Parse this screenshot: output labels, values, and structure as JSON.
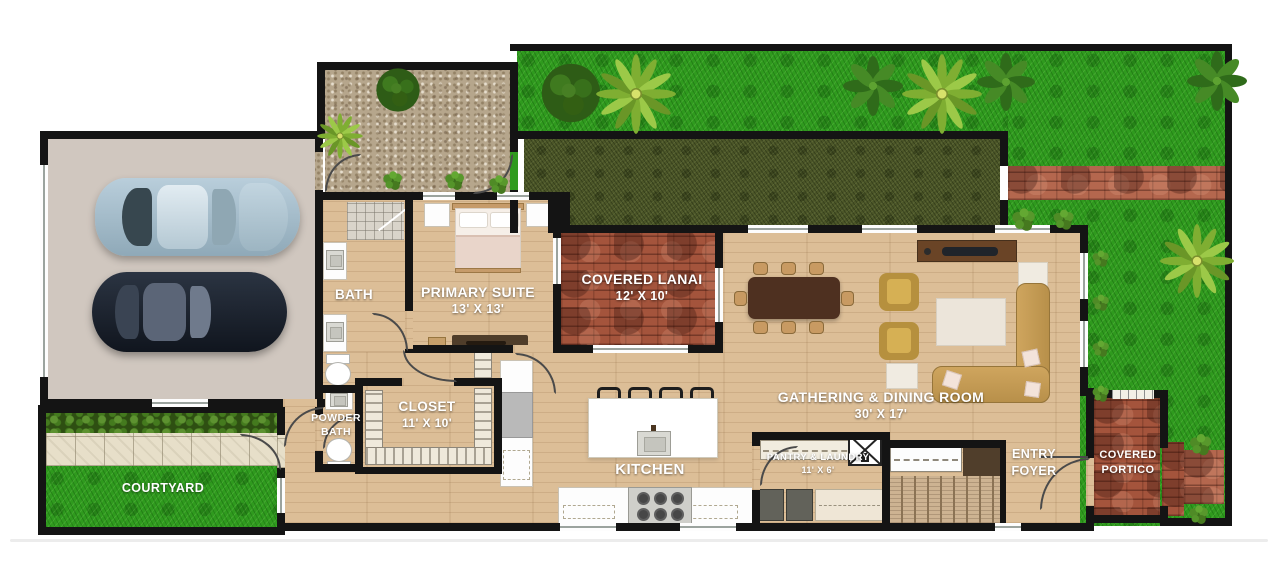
{
  "rooms": {
    "bath": {
      "label": "BATH"
    },
    "primary_suite": {
      "label": "PRIMARY SUITE",
      "dims": "13' X 13'"
    },
    "covered_lanai": {
      "label": "COVERED LANAI",
      "dims": "12' X 10'"
    },
    "gathering_dining": {
      "label": "GATHERING & DINING ROOM",
      "dims": "30' X 17'"
    },
    "closet": {
      "label": "CLOSET",
      "dims": "11' X 10'"
    },
    "powder_bath": {
      "label": "POWDER BATH"
    },
    "kitchen": {
      "label": "KITCHEN"
    },
    "pantry_laundry": {
      "label": "PANTRY & LAUNDRY",
      "dims": "11' X 6'"
    },
    "entry_foyer": {
      "label": "ENTRY FOYER"
    },
    "covered_portico": {
      "label": "COVERED PORTICO"
    },
    "courtyard": {
      "label": "COURTYARD"
    }
  },
  "colors": {
    "wall": "#141414",
    "wood_floor": "#dcbe97",
    "grass": "#2f9a1e",
    "hedge": "#4c5628",
    "brick": "#a4543c",
    "gravel": "#b6a68c",
    "stone_path": "#e7dfc9",
    "garage_floor": "#d0c7bf",
    "label_text": "#ffffff"
  }
}
